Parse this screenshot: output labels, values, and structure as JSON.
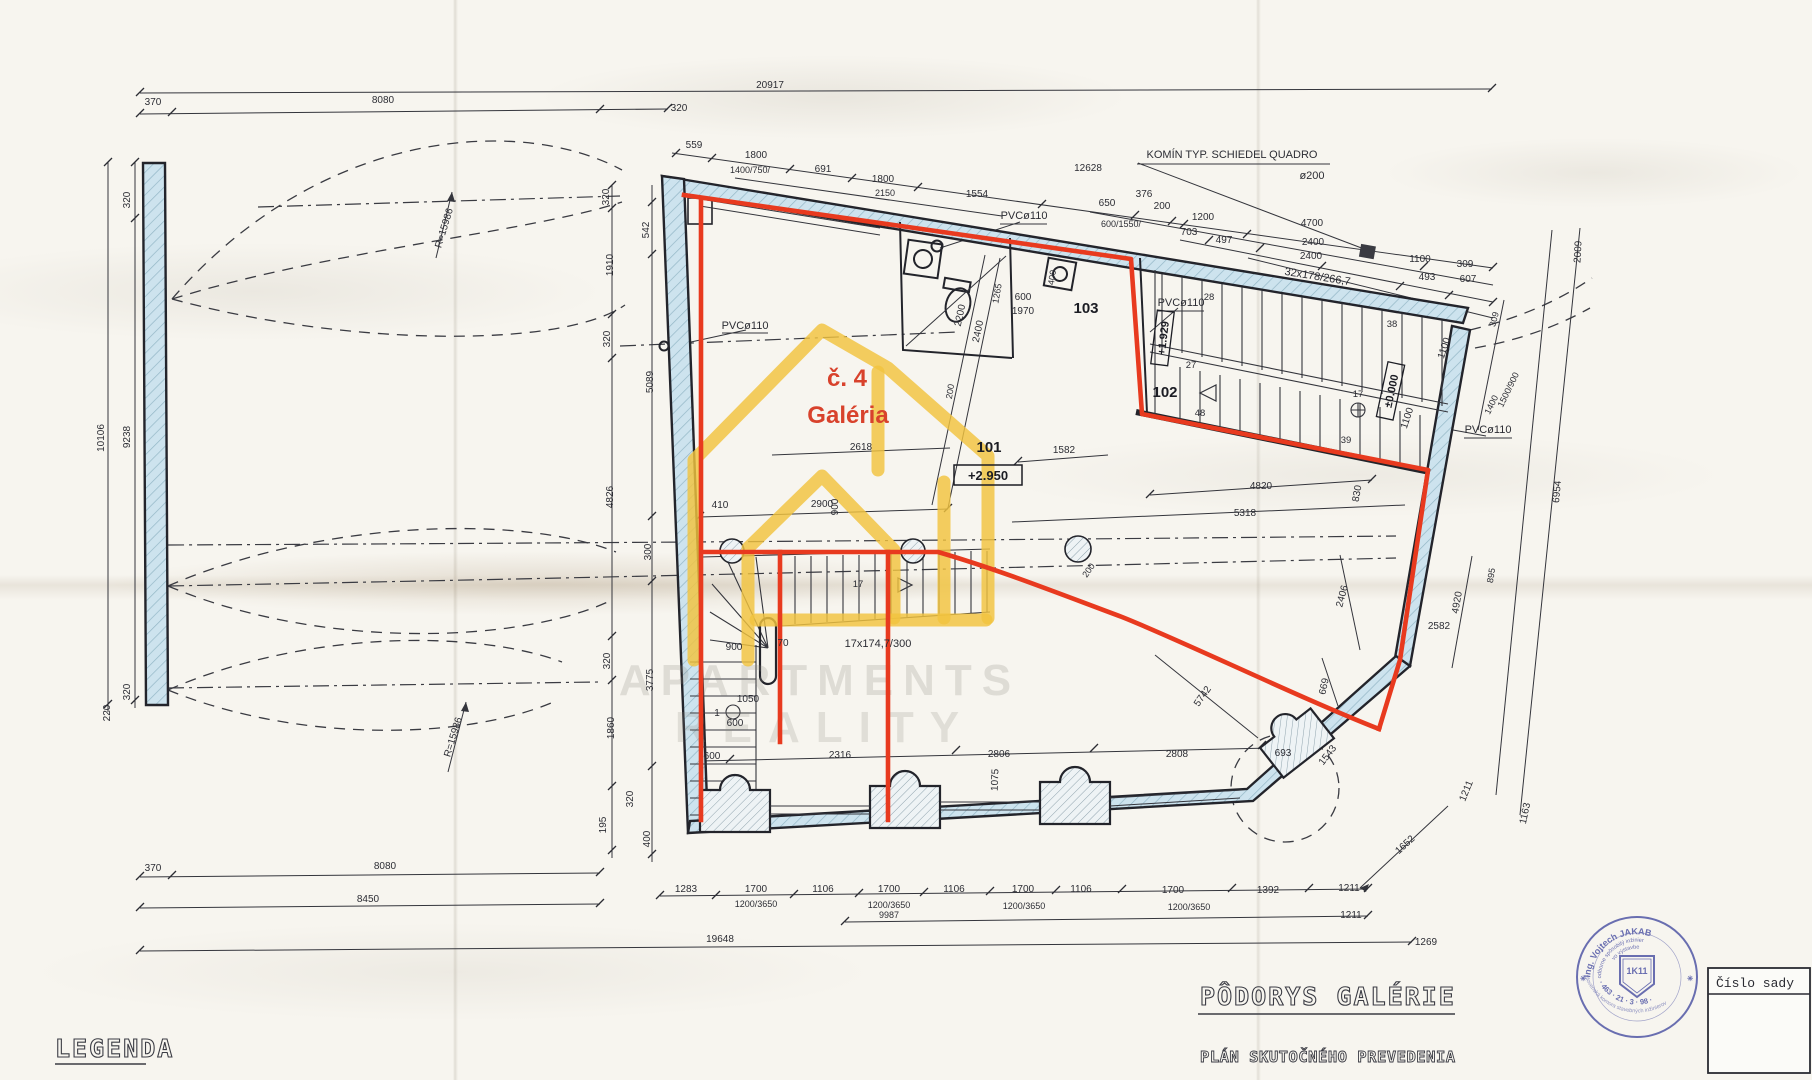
{
  "drawing": {
    "title": "PÔDORYS GALÉRIE",
    "subtitle": "PLÁN SKUTOČNÉHO PREVEDENIA",
    "legend": "LEGENDA",
    "set_number_label": "Číslo sady"
  },
  "unit": {
    "number": "č. 4",
    "name": "Galéria"
  },
  "rooms": {
    "r101": "101",
    "r102": "102",
    "r103": "103"
  },
  "levels": {
    "gallery": "+2.950",
    "landing": "+1.929",
    "ground": "±0.000"
  },
  "annotations": {
    "chimney1": "KOMÍN TYP. SCHIEDEL QUADRO",
    "chimney2": "ø200",
    "main_stair": "32x178/266,7",
    "winder_stair": "17x174,7/300",
    "pvc1": "PVCø110",
    "pvc2": "PVCø110",
    "pvc3": "PVCø110",
    "pvc4": "PVCø110",
    "radius_top": "R=15986",
    "radius_bottom": "R=15986"
  },
  "watermark": {
    "line1": "APARTMENTS",
    "line2": "REALITY"
  },
  "stamp": {
    "name": "Ing. Vojtech JAKAB",
    "role1": "odborne spôsobilý inžinier",
    "role2": "vo výstavbe",
    "code": "1K11",
    "number": "· 463 · 21 · 3 · 98 ·",
    "chamber": "Slovenská komora stavebných inžinierov"
  },
  "stair_steps": {
    "s28": "28",
    "s27": "27",
    "s48": "48",
    "s38": "38",
    "s17": "17",
    "s39": "39",
    "w17": "17"
  },
  "colors": {
    "outline_red": "#e83a1f",
    "logo_yellow": "#f2c33e",
    "wall_blue": "#cde3ee",
    "stamp_blue": "#565ca8"
  },
  "dims": {
    "top": [
      "20917",
      "370",
      "8080",
      "320",
      "559",
      "1800",
      "1400/750/",
      "691",
      "1800",
      "2150",
      "1554",
      "12628",
      "650",
      "600/1550/",
      "376",
      "200",
      "1200",
      "703",
      "497",
      "4700",
      "2400",
      "2400",
      "1100",
      "309",
      "493",
      "607"
    ],
    "left_outer": [
      "320",
      "10106",
      "9238",
      "320",
      "220"
    ],
    "left_inner": [
      "320",
      "542",
      "1910",
      "320",
      "5089",
      "4826",
      "300",
      "320",
      "3775",
      "1860",
      "320",
      "195",
      "400"
    ],
    "interior": [
      "2200",
      "2400",
      "1265",
      "600",
      "1970",
      "400",
      "200",
      "410",
      "2900",
      "2618",
      "900",
      "900",
      "70",
      "1050",
      "1",
      "600",
      "200",
      "1582",
      "4820",
      "830",
      "5318",
      "2406",
      "2582",
      "669",
      "5742",
      "600",
      "2316",
      "2806",
      "2808",
      "693",
      "1543",
      "1075"
    ],
    "right": [
      "2009",
      "309",
      "1100",
      "1100",
      "1400",
      "1500/900",
      "6954",
      "895",
      "4920",
      "1211",
      "1163",
      "1652"
    ],
    "bottom": [
      "370",
      "8080",
      "8450",
      "19648",
      "1283",
      "1700",
      "1106",
      "1700",
      "1106",
      "1700",
      "1106",
      "1700",
      "1392",
      "1211",
      "1200/3650",
      "1200/3650",
      "9987",
      "1200/3650",
      "1200/3650",
      "1211",
      "1269"
    ]
  }
}
